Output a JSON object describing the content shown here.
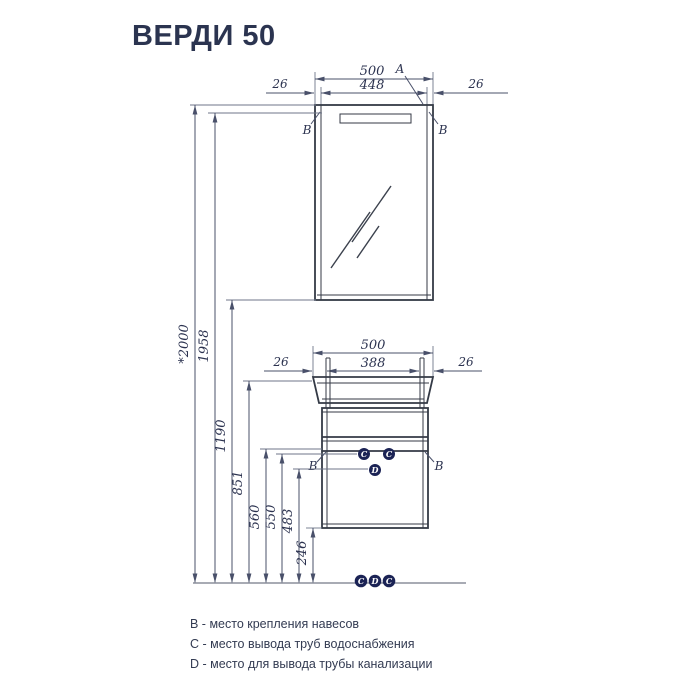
{
  "title": "ВЕРДИ 50",
  "mirror": {
    "dim_total": "500",
    "dim_inner": "448",
    "dim_left": "26",
    "dim_right": "26",
    "label_a": "A",
    "label_b_left": "B",
    "label_b_right": "B"
  },
  "vanity": {
    "dim_total": "500",
    "dim_inner": "388",
    "dim_left": "26",
    "dim_right": "26",
    "label_b_left": "B",
    "label_b_right": "B",
    "pipe_c_left": "C",
    "pipe_c_right": "C",
    "pipe_d": "D"
  },
  "vertical_dims": [
    "*2000",
    "1958",
    "1190",
    "851",
    "560",
    "550",
    "483",
    "246"
  ],
  "floor_markers": [
    "C",
    "D",
    "C"
  ],
  "legend": [
    "B - место крепления навесов",
    "C - место вывода труб водоснабжения",
    "D - место для вывода трубы канализации"
  ],
  "colors": {
    "accent": "#1b2355",
    "ink": "#2c3350",
    "line": "#343a46"
  }
}
